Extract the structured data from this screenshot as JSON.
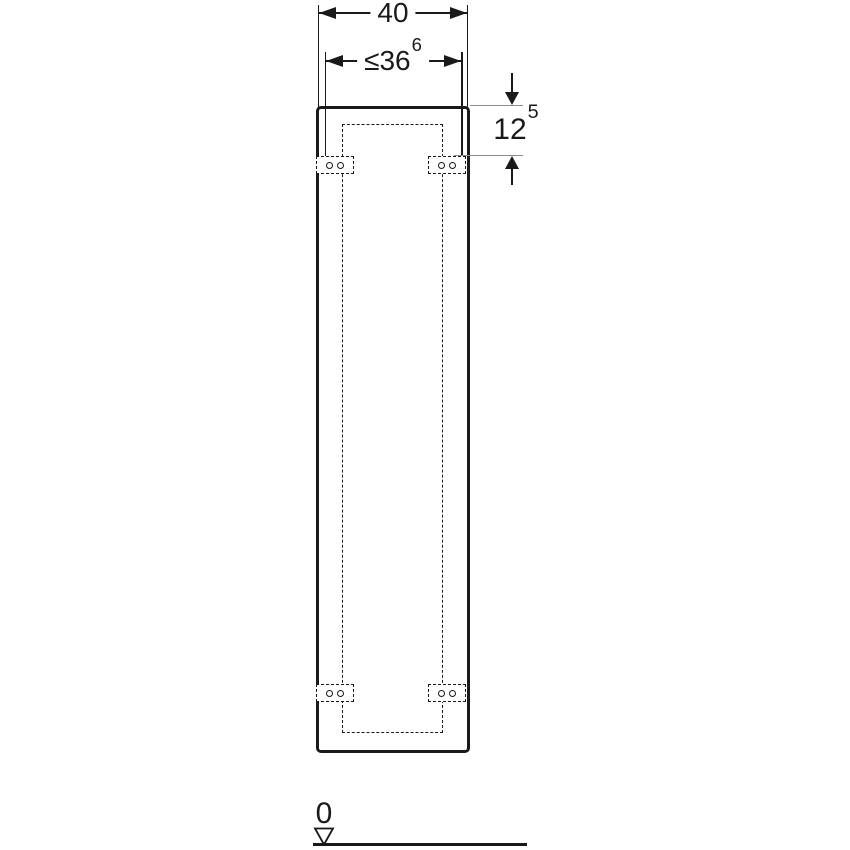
{
  "colors": {
    "ink": "#1a1a1a",
    "extension_line": "#8c8c8c",
    "background": "#ffffff"
  },
  "dims": {
    "overall_width": {
      "main": "40"
    },
    "mount_width": {
      "main": "≤36",
      "sup": "6"
    },
    "top_offset": {
      "main": "12",
      "sup": "5"
    }
  },
  "datum": {
    "label": "0"
  }
}
